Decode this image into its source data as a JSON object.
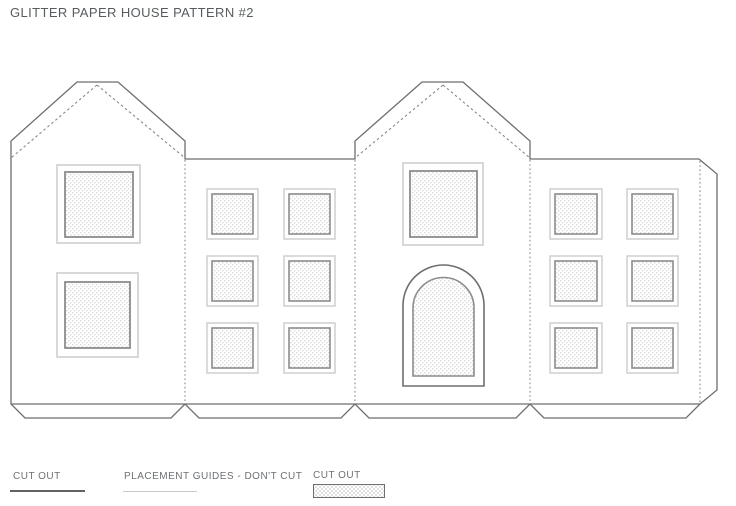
{
  "title": "GLITTER PAPER HOUSE PATTERN #2",
  "legend": {
    "items": [
      {
        "label": "CUT OUT",
        "style": "solid-dark-line"
      },
      {
        "label": "PLACEMENT GUIDES - DON'T CUT",
        "style": "light-gray-line"
      },
      {
        "label": "CUT OUT",
        "style": "hatched-swatch"
      }
    ]
  },
  "pattern": {
    "panels": [
      {
        "name": "left-gable-wall",
        "windows": 2,
        "doors": 0
      },
      {
        "name": "left-side-wall",
        "windows": 6,
        "doors": 0
      },
      {
        "name": "center-gable-wall",
        "windows": 1,
        "doors": 1
      },
      {
        "name": "right-side-wall",
        "windows": 6,
        "doors": 0
      }
    ],
    "glue_tab": "right-edge",
    "bottom_flaps": 4
  },
  "colors": {
    "background": "#ffffff",
    "outline": "#6e6e6e",
    "fold_guide": "#8a8a8a",
    "window_frame_outer": "#cfcfcf",
    "window_frame_inner": "#8c8c8c",
    "hatch_dot": "#d7d7d7",
    "title_text": "#585c5f",
    "legend_text": "#6d7174",
    "legend_solid_line": "#5f6366",
    "legend_light_line": "#c8c8c8"
  }
}
